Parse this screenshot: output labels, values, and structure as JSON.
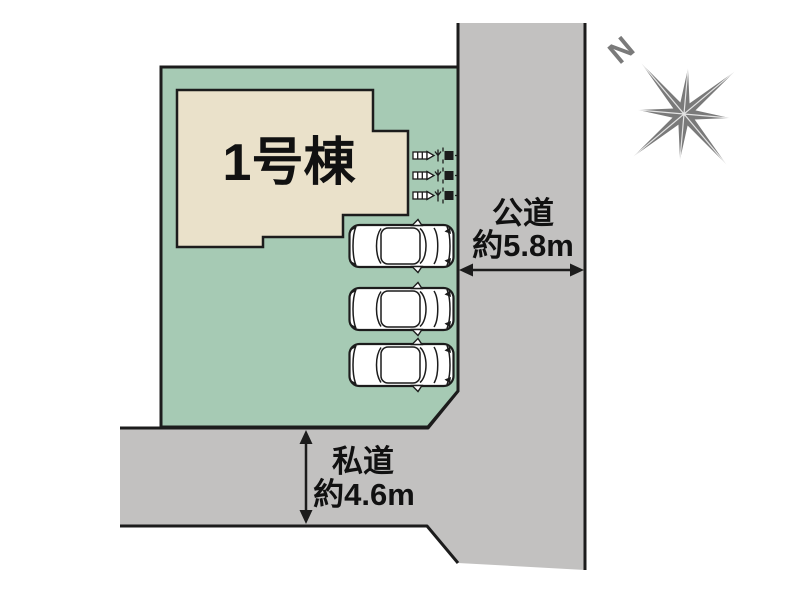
{
  "site_plan": {
    "building": {
      "label": "1号棟"
    },
    "compass": {
      "north_label": "N"
    },
    "roads": {
      "public": {
        "name": "公道",
        "width_label": "約5.8m"
      },
      "private": {
        "name": "私道",
        "width_label": "約4.6m"
      }
    },
    "parking": {
      "car_count": 3
    },
    "utility_meters": {
      "count": 3
    },
    "colors": {
      "plot-green": "#a6cab4",
      "building-beige": "#eae1ca",
      "road-gray": "#c2c1c0",
      "compass-gray": "#7a7a7a",
      "line-black": "#1c1c1c",
      "text-black": "#111111",
      "background": "#ffffff"
    }
  }
}
